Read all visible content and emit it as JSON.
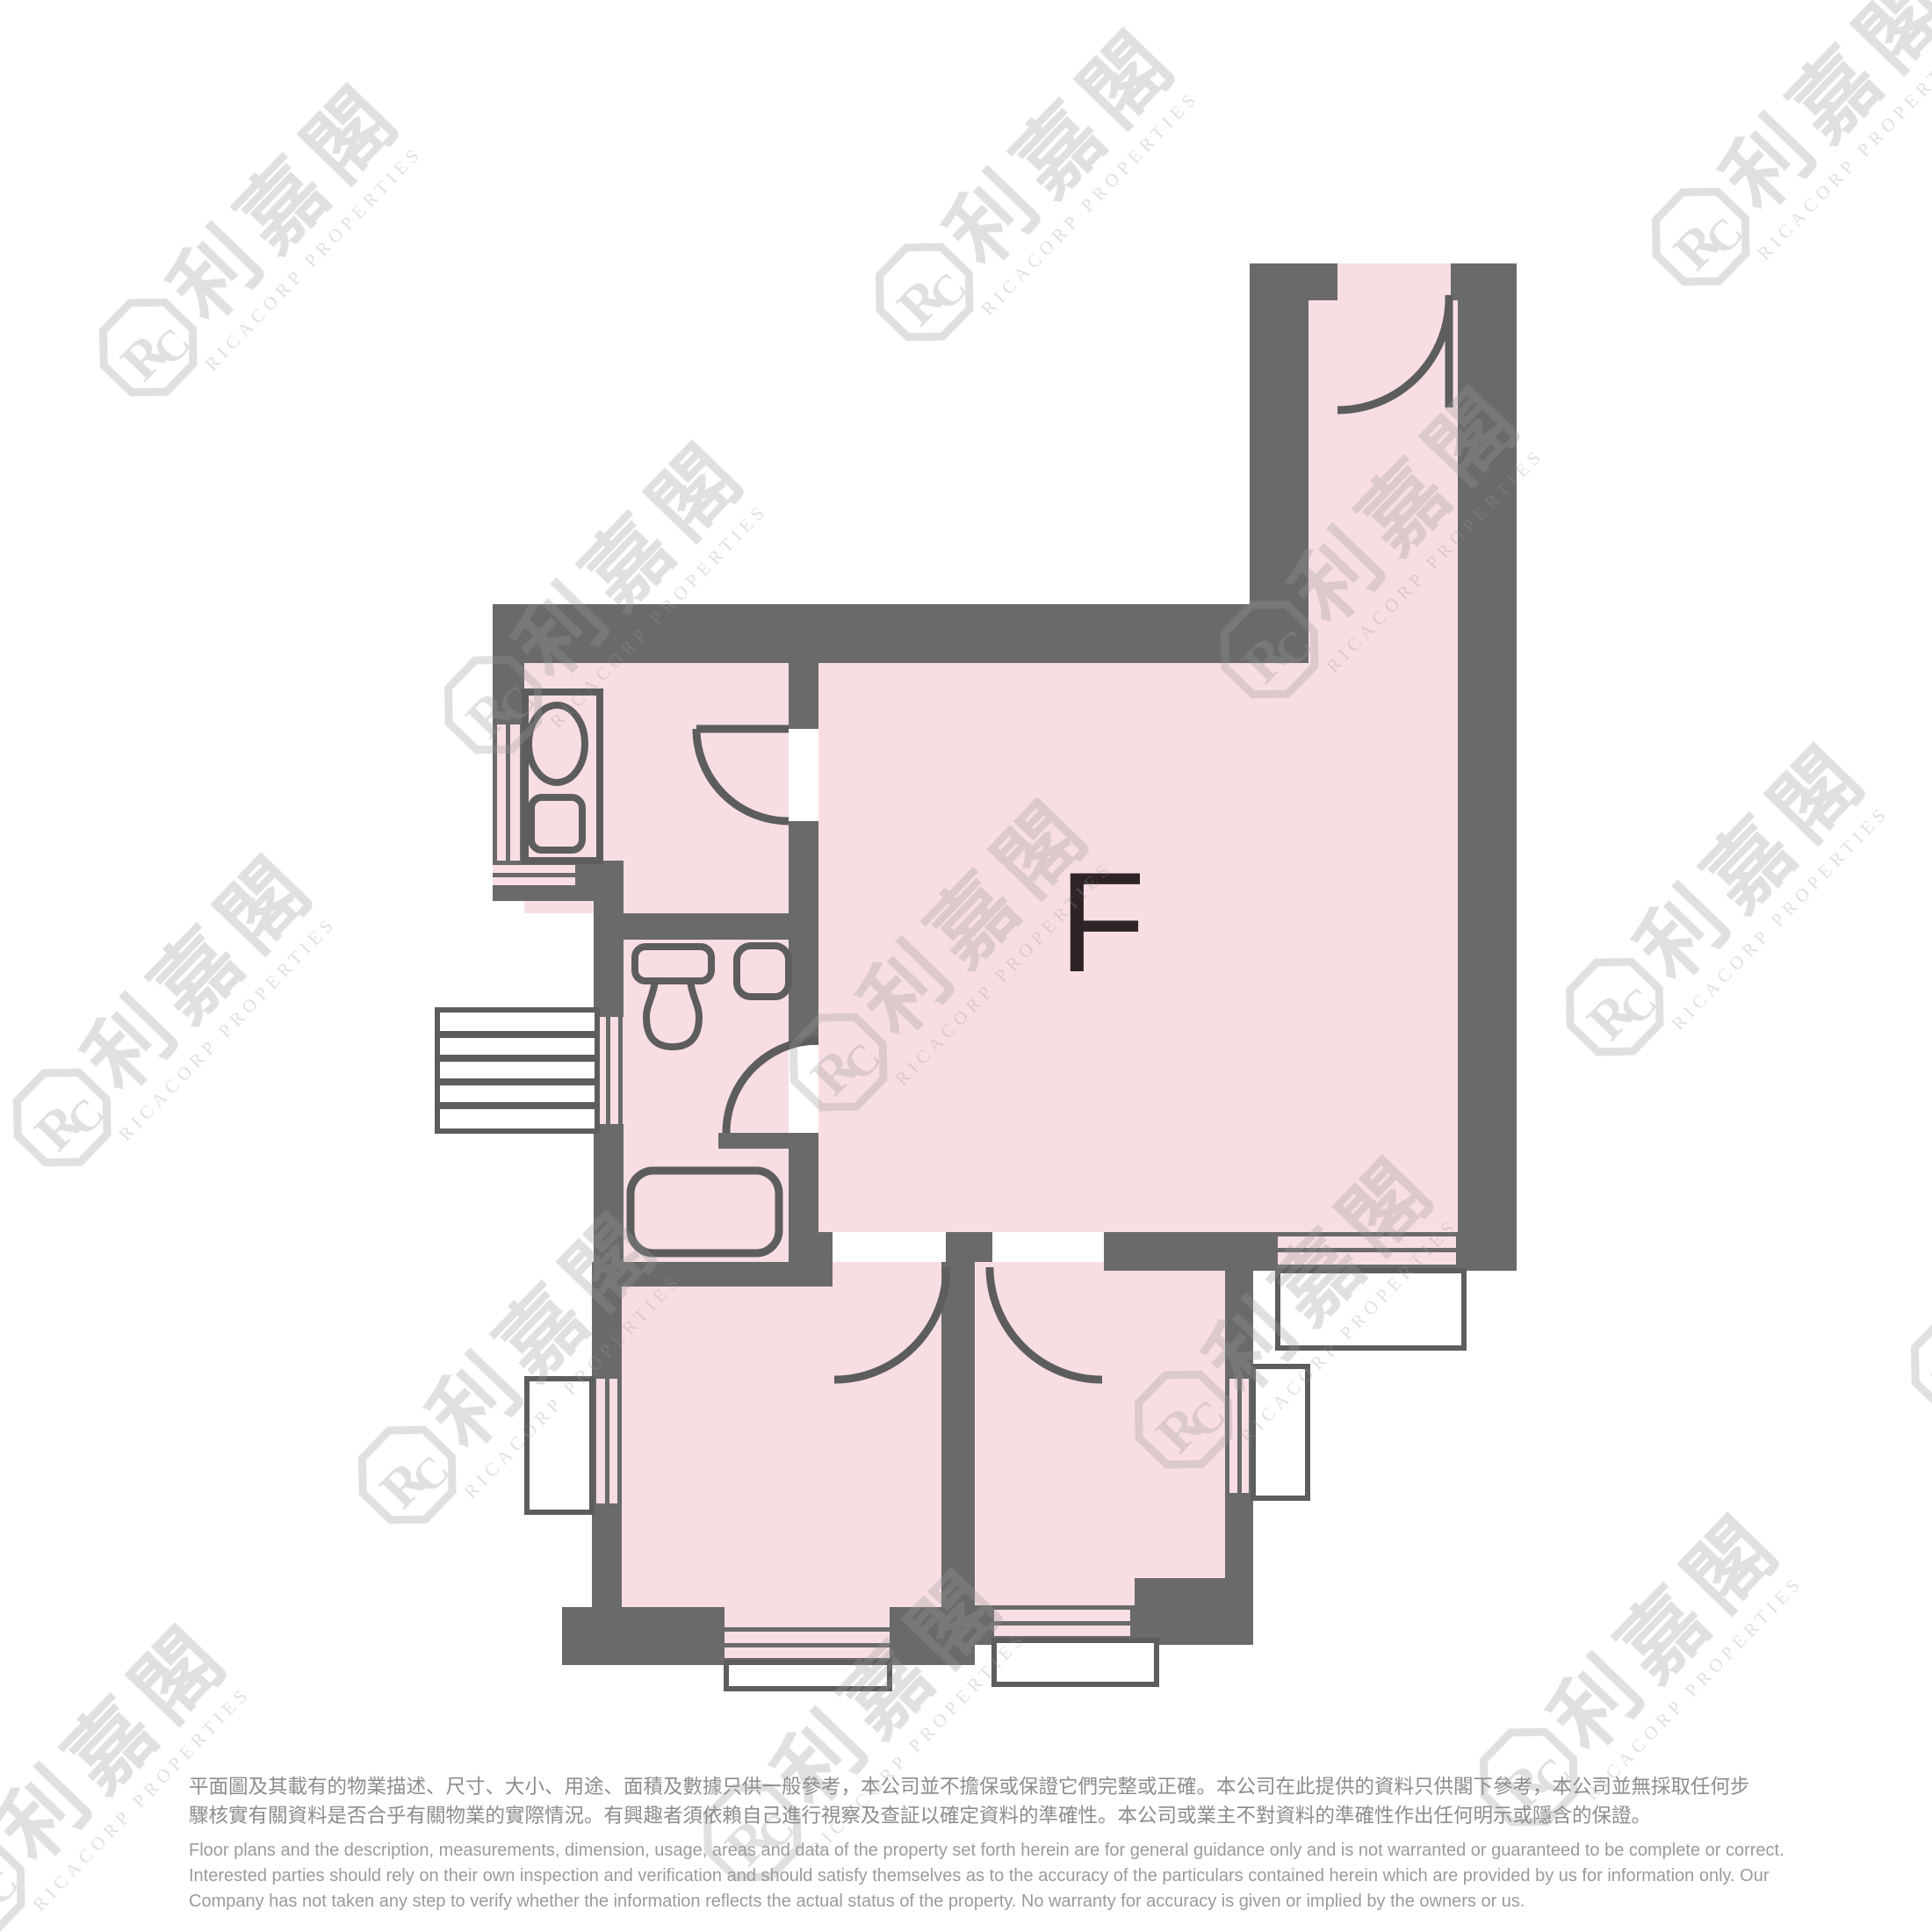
{
  "unit_label": "F",
  "watermark": {
    "cjk": "利嘉閣",
    "latin": "RICACORP PROPERTIES",
    "monogram_r": "R",
    "monogram_c": "C"
  },
  "disclaimer": {
    "zh": [
      "平面圖及其載有的物業描述、尺寸、大小、用途、面積及數據只供一般參考，本公司並不擔保或保證它們完整或正確。本公司在此提供的資料只供閣下參考，本公司並無採取任何步",
      "驟核實有關資料是否合乎有關物業的實際情況。有興趣者須依賴自己進行視察及查証以確定資料的準確性。本公司或業主不對資料的準確性作出任何明示或隱含的保證。"
    ],
    "en": [
      "Floor plans and the description, measurements, dimension, usage, areas and data of the property set forth herein are for general guidance only and is not warranted or guaranteed to be complete or correct.",
      "Interested parties should rely on their own inspection and verification and should satisfy themselves as to the accuracy of the particulars contained herein which are provided by us for information only.  Our",
      "Company has not taken any step to verify whether the information reflects the actual status of the property.  No warranty for accuracy is given or implied by the owners or us."
    ]
  },
  "colors": {
    "room_pink": "#f8dee3",
    "wall_gray": "#6a6a6a",
    "line_gray": "#5d5d5d",
    "label_dark": "#2e2426",
    "text_zh": "#8d8d8d",
    "text_en": "#9b9b9b",
    "watermark": "#e9e9e9"
  }
}
